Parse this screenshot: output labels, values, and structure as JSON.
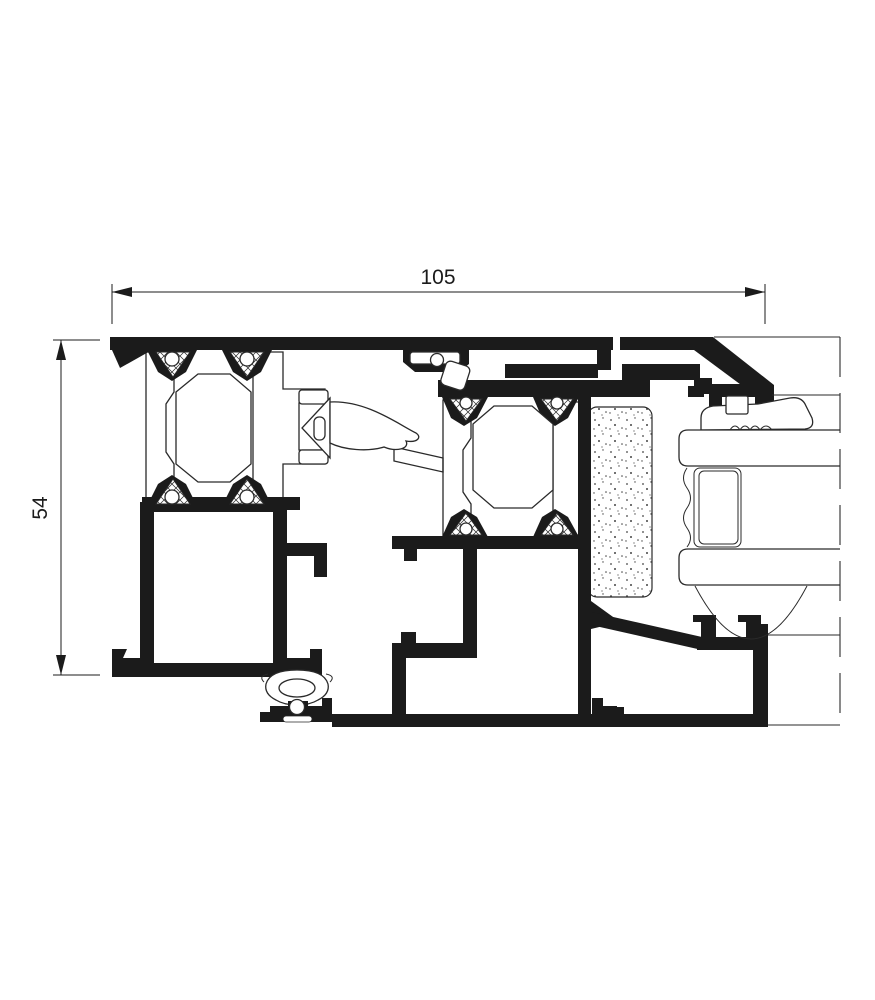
{
  "drawing": {
    "kind": "aluminium window profile cross-section",
    "dims": {
      "width_label": "105",
      "height_label": "54"
    },
    "colors": {
      "ink": "#1b1b1b",
      "background": "#ffffff",
      "thin_line": "#2a2a2a"
    }
  }
}
